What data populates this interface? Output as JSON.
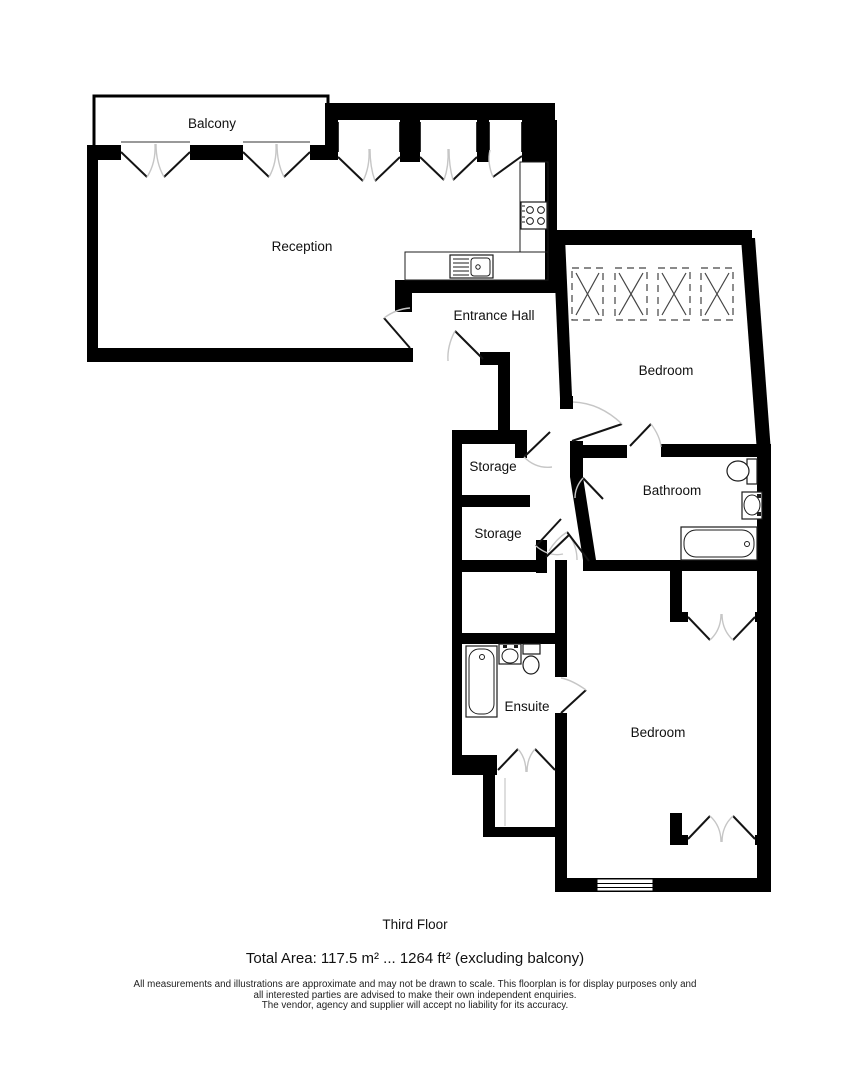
{
  "floorplan": {
    "rooms": [
      {
        "id": "balcony",
        "label": "Balcony"
      },
      {
        "id": "reception",
        "label": "Reception"
      },
      {
        "id": "entrance-hall",
        "label": "Entrance Hall"
      },
      {
        "id": "storage-a",
        "label": "Storage"
      },
      {
        "id": "storage-b",
        "label": "Storage"
      },
      {
        "id": "bedroom-front",
        "label": "Bedroom"
      },
      {
        "id": "bathroom",
        "label": "Bathroom"
      },
      {
        "id": "ensuite",
        "label": "Ensuite"
      },
      {
        "id": "bedroom-back",
        "label": "Bedroom"
      }
    ],
    "fixtures": [
      "kitchen-sink",
      "hob",
      "worktop",
      "wardrobe",
      "toilet",
      "basin",
      "bathtub",
      "window",
      "double-doors"
    ],
    "colors": {
      "wall": "#000000",
      "door_leaf": "#141414",
      "door_arc": "#c6c6c6",
      "background": "#ffffff",
      "label": "#111111"
    }
  },
  "footer": {
    "floor_label": "Third Floor",
    "total_area": "Total Area: 117.5 m² ... 1264 ft² (excluding balcony)",
    "disclaimer_lines": [
      "All measurements and illustrations are approximate and may not be drawn to scale. This floorplan is for display purposes only and",
      "all interested parties are advised to make their own independent enquiries.",
      "The vendor, agency and supplier will accept no liability for its accuracy."
    ]
  }
}
